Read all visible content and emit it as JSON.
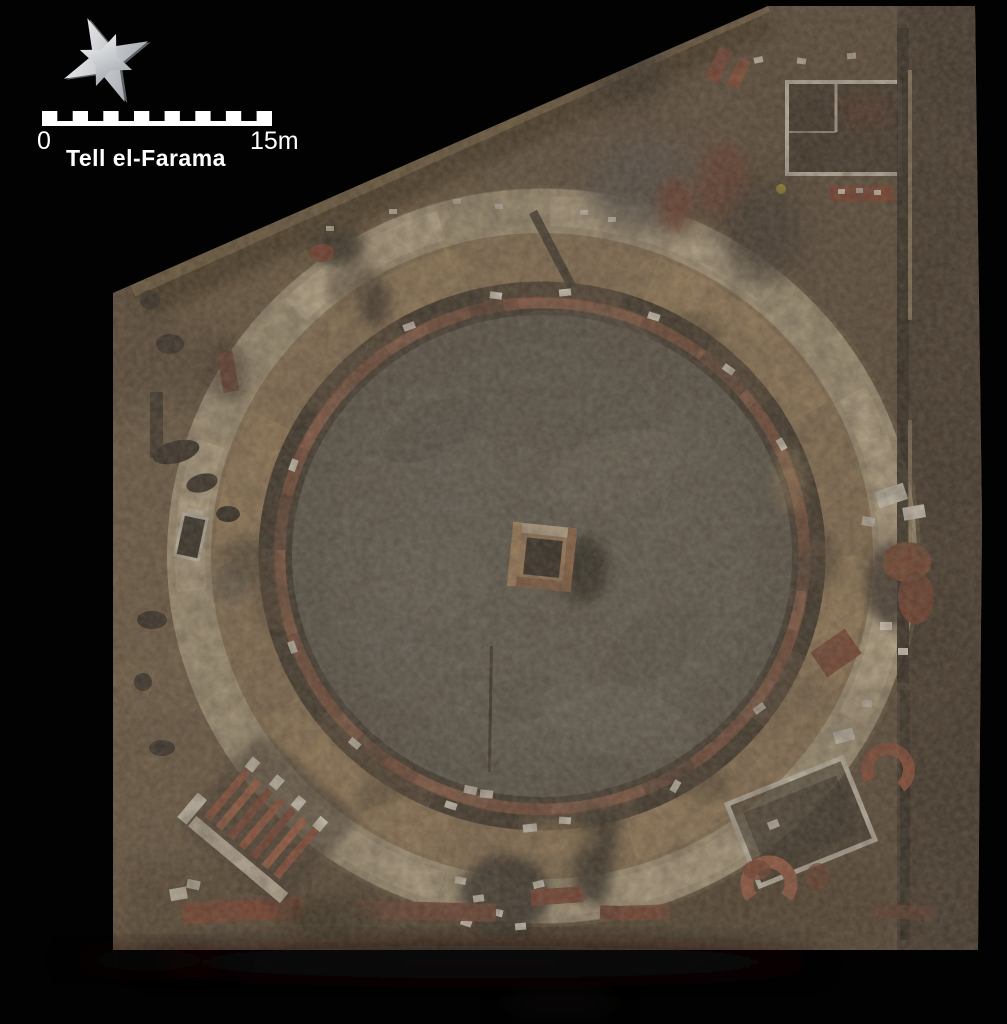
{
  "figure": {
    "site_label": "Tell el-Farama",
    "scale_bar": {
      "start_label": "0",
      "end_label": "15m",
      "segments": 15,
      "length_meters": 15
    },
    "north_arrow_icon": "eight-pointed-compass-star",
    "colors": {
      "background": "#000000",
      "legend_text": "#ffffff",
      "terrain_base": "#5b4b3a",
      "outer_corridor": "#ab9c7f",
      "cavea_ring": "#8c7456",
      "brick_wall": "#7c4a37",
      "arena_floor": "#625e55",
      "central_pit": "#29251f",
      "stone_blocks": "#d9d4c6"
    }
  }
}
